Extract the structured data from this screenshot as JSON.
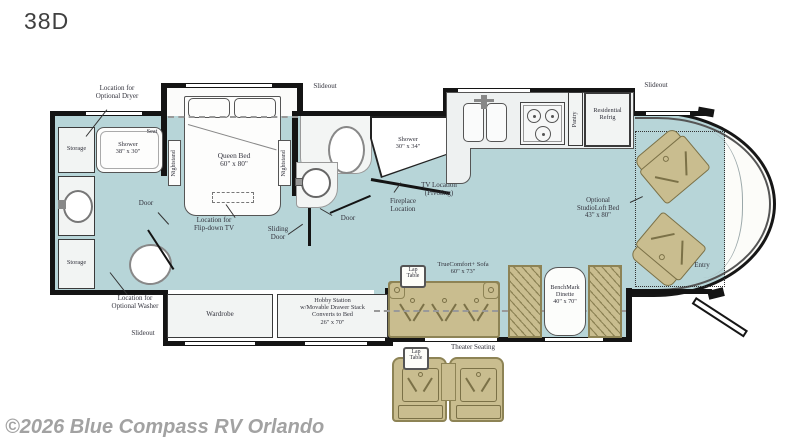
{
  "page": {
    "title": "38D",
    "watermark": "©2026 Blue Compass RV Orlando"
  },
  "colors": {
    "floor": "#b7d5d8",
    "furniture": "#c9bd8f",
    "furniture_border": "#8d8355",
    "wall": "#141414",
    "label": "#33333d",
    "watermark": "#a2a2a2"
  },
  "labels": {
    "slideout_bedroom": "Slideout",
    "slideout_kitchen": "Slideout",
    "slideout_bottom": "Slideout",
    "dryer": "Location for\nOptional Dryer",
    "washer": "Location for\nOptional Washer",
    "storage_top": "Storage",
    "storage_bottom": "Storage",
    "shower_rear": "Shower\n38\" x 30\"",
    "seat": "Seat",
    "door_rear": "Door",
    "nightstand_left": "Nightstand",
    "nightstand_right": "Nightstand",
    "queen_bed": "Queen Bed\n60\" x 80\"",
    "flip_tv": "Location for\nFlip-down TV",
    "sliding_door": "Sliding\nDoor",
    "door_mid": "Door",
    "shower_mid": "Shower\n30\" x 34\"",
    "tv_location": "TV Location\n(Pivoting)",
    "fireplace": "Fireplace\nLocation",
    "pantry": "Pantry",
    "refrig": "Residential\nRefrig",
    "studioloft": "Optional\nStudioLoft Bed\n43\" x 80\"",
    "entry": "Entry",
    "wardrobe": "Wardrobe",
    "hobby": "Hobby Station\nw/Movable Drawer Stack\nConverts to Bed\n26\" x 70\"",
    "lap_table_sofa": "Lap\nTable",
    "sofa": "TrueComfort+ Sofa\n60\" x 73\"",
    "dinette": "BenchMark\nDinette\n40\" x 70\"",
    "lap_table_theater": "Lap\nTable",
    "theater": "Theater Seating"
  }
}
